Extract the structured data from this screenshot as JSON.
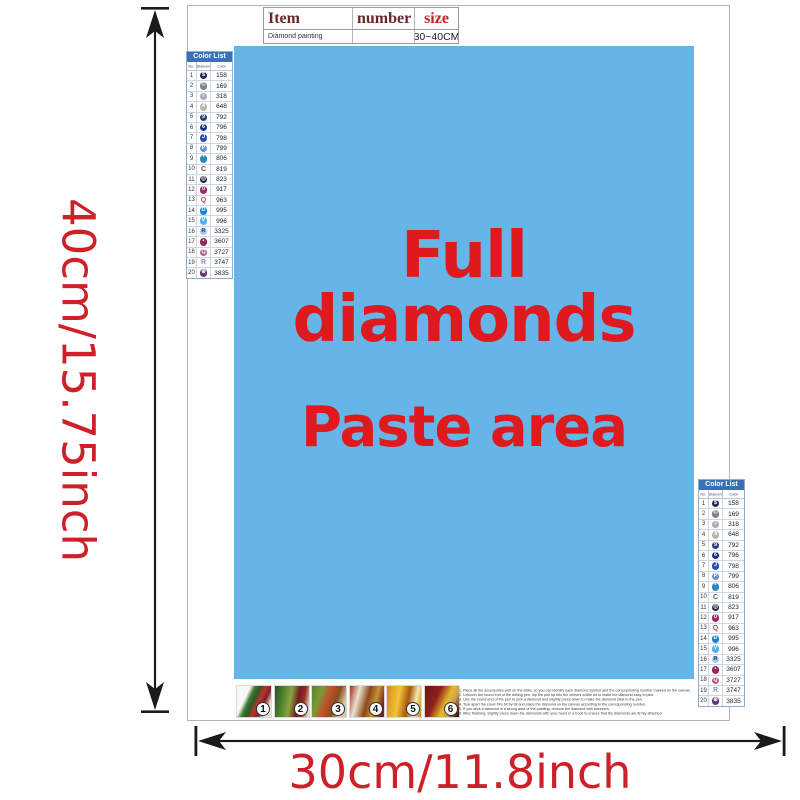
{
  "dimensions": {
    "height_label": "40cm/15.75inch",
    "width_label": "30cm/11.8inch",
    "arrow_color": "#1a1a1a",
    "label_color": "#ce2028"
  },
  "item_table": {
    "header_item": "Item",
    "header_number": "number",
    "header_size": "size",
    "value_item": "Diamond painting",
    "value_number": "",
    "value_size": "30~40CM"
  },
  "paste_area": {
    "line1": "Full diamonds",
    "line2": "Paste area",
    "bg_color": "#66b5e9",
    "text_color": "#df1a1e"
  },
  "color_list": {
    "title": "Color List",
    "headers": [
      "No.",
      "Diamond",
      "Color"
    ],
    "rows": [
      {
        "no": "1",
        "code": "158",
        "type": "dot",
        "dot": "#262659",
        "glyph": "$",
        "glyph_color": "#ffffff"
      },
      {
        "no": "2",
        "code": "169",
        "type": "dot",
        "dot": "#7d8187",
        "glyph": "©",
        "glyph_color": "#ffffff"
      },
      {
        "no": "3",
        "code": "318",
        "type": "dot",
        "dot": "#a6a8ab",
        "glyph": "≡",
        "glyph_color": "#ffffff"
      },
      {
        "no": "4",
        "code": "648",
        "type": "dot",
        "dot": "#b7b7a9",
        "glyph": "4",
        "glyph_color": "#ffffff"
      },
      {
        "no": "5",
        "code": "792",
        "type": "dot",
        "dot": "#2d3d78",
        "glyph": "9",
        "glyph_color": "#ffffff"
      },
      {
        "no": "6",
        "code": "796",
        "type": "dot",
        "dot": "#16307f",
        "glyph": "6",
        "glyph_color": "#ffffff"
      },
      {
        "no": "7",
        "code": "798",
        "type": "dot",
        "dot": "#2c50a5",
        "glyph": "J",
        "glyph_color": "#ffffff"
      },
      {
        "no": "8",
        "code": "799",
        "type": "dot",
        "dot": "#7390cc",
        "glyph": "P",
        "glyph_color": "#ffffff"
      },
      {
        "no": "9",
        "code": "806",
        "type": "dot",
        "dot": "#2d86c2",
        "glyph": "*",
        "glyph_color": "#ffffff"
      },
      {
        "no": "10",
        "code": "819",
        "type": "letter",
        "letter": "C",
        "letter_color": "#555555"
      },
      {
        "no": "11",
        "code": "823",
        "type": "dot",
        "dot": "#1d2543",
        "glyph": "◎",
        "glyph_color": "#ffffff"
      },
      {
        "no": "12",
        "code": "917",
        "type": "dot",
        "dot": "#9a2a68",
        "glyph": "0",
        "glyph_color": "#ffffff"
      },
      {
        "no": "13",
        "code": "963",
        "type": "letter",
        "letter": "Q",
        "letter_color": "#b04a62"
      },
      {
        "no": "14",
        "code": "995",
        "type": "dot",
        "dot": "#1e7fd2",
        "glyph": "D",
        "glyph_color": "#ffffff"
      },
      {
        "no": "15",
        "code": "996",
        "type": "dot",
        "dot": "#4fb2ea",
        "glyph": "V",
        "glyph_color": "#ffffff"
      },
      {
        "no": "16",
        "code": "3325",
        "type": "dot",
        "dot": "#a6c6ea",
        "glyph": "R",
        "glyph_color": "#1b3a7a"
      },
      {
        "no": "17",
        "code": "3607",
        "type": "dot",
        "dot": "#8f2a60",
        "glyph": "•",
        "glyph_color": "#ffffff"
      },
      {
        "no": "18",
        "code": "3727",
        "type": "dot",
        "dot": "#b05f82",
        "glyph": "Q",
        "glyph_color": "#ffffff"
      },
      {
        "no": "19",
        "code": "3747",
        "type": "letter",
        "letter": "R",
        "letter_color": "#8b90c2"
      },
      {
        "no": "20",
        "code": "3835",
        "type": "dot",
        "dot": "#5c3a75",
        "glyph": "⊕",
        "glyph_color": "#ffffff"
      }
    ]
  },
  "steps": {
    "items": [
      {
        "n": "1",
        "bg": "linear-gradient(115deg,#f8f8f4 0%,#f8f8f4 28%,#3f7c35 38%,#2c5a24 48%,#b8342a 60%,#7e222a 72%,#efe8da 86%)"
      },
      {
        "n": "2",
        "bg": "linear-gradient(100deg,#24551f 0%,#5d8c33 30%,#8aa33f 45%,#6e1f1f 65%,#9c2c24 80%,#ddd6c4 95%)"
      },
      {
        "n": "3",
        "bg": "linear-gradient(110deg,#57822e 0%,#7a9a35 25%,#c1502a 45%,#8a4a1e 65%,#d8c9a0 85%)"
      },
      {
        "n": "4",
        "bg": "linear-gradient(105deg,#a82820 0%,#e9e2d2 25%,#8a4a18 50%,#c59038 70%,#70281e 90%)"
      },
      {
        "n": "5",
        "bg": "linear-gradient(100deg,#d98a1a 0%,#f2c33a 35%,#a85410 60%,#f7e6ae 80%,#c9861c 100%)"
      },
      {
        "n": "6",
        "bg": "linear-gradient(115deg,#6e1616 0%,#8f1f1c 35%,#e3bb2e 60%,#c8a058 75%,#46180c 95%)"
      }
    ]
  },
  "instructions": {
    "lines": [
      "1. Place all the accessories well on the table, so you can identify each diamond symbol and the corresponding number marked on the canvas.",
      "2. Uncover the round end of the drilling pen, dip the pen tip into the cement a little bit to make the diamond easy to pick.",
      "3. Use the round end of the pen to pick a diamond and slightly press down to make the diamond stick to the pen.",
      "4. Tear apart the cover film bit by bit and place the diamond on the canvas according to the corresponding number.",
      "5. If you stick a diamond in a wrong area of the painting, remove the diamond with tweezers.",
      "6. After finishing, slightly press down the diamonds with your hand or a book to ensure that the diamonds are firmly attached."
    ]
  }
}
